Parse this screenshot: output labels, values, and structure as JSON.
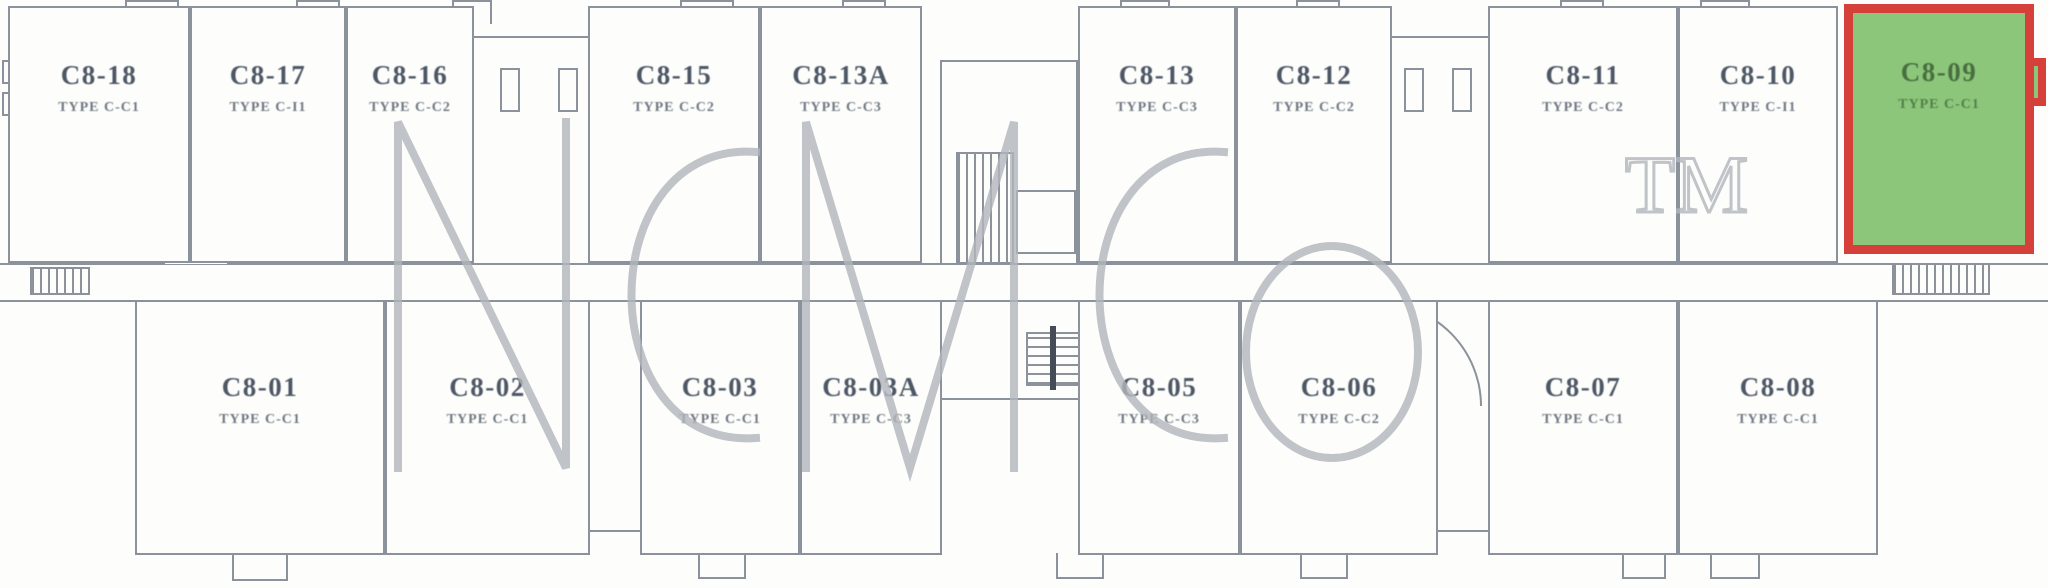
{
  "watermark": {
    "text": "NCMCo",
    "tm": "TM",
    "color": "#b2b6bc"
  },
  "highlight": {
    "unit": "C8-09",
    "fill": "#8cc67a",
    "border": "#d6403a"
  },
  "colors": {
    "line": "#8b929c",
    "ink": "#4d5765",
    "paper": "#fdfdfb"
  },
  "units": [
    {
      "id": "C8-18",
      "type": "TYPE C-C1",
      "row": "top",
      "x": 8,
      "y": 6,
      "w": 182,
      "h": 257,
      "highlighted": false
    },
    {
      "id": "C8-17",
      "type": "TYPE C-I1",
      "row": "top",
      "x": 190,
      "y": 6,
      "w": 156,
      "h": 257,
      "highlighted": false
    },
    {
      "id": "C8-16",
      "type": "TYPE C-C2",
      "row": "top",
      "x": 346,
      "y": 6,
      "w": 128,
      "h": 257,
      "highlighted": false
    },
    {
      "id": "C8-15",
      "type": "TYPE C-C2",
      "row": "top",
      "x": 588,
      "y": 6,
      "w": 172,
      "h": 257,
      "highlighted": false
    },
    {
      "id": "C8-13A",
      "type": "TYPE C-C3",
      "row": "top",
      "x": 760,
      "y": 6,
      "w": 162,
      "h": 257,
      "highlighted": false
    },
    {
      "id": "C8-13",
      "type": "TYPE C-C3",
      "row": "top",
      "x": 1078,
      "y": 6,
      "w": 158,
      "h": 257,
      "highlighted": false
    },
    {
      "id": "C8-12",
      "type": "TYPE C-C2",
      "row": "top",
      "x": 1236,
      "y": 6,
      "w": 156,
      "h": 257,
      "highlighted": false
    },
    {
      "id": "C8-11",
      "type": "TYPE C-C2",
      "row": "top",
      "x": 1488,
      "y": 6,
      "w": 190,
      "h": 257,
      "highlighted": false
    },
    {
      "id": "C8-10",
      "type": "TYPE C-I1",
      "row": "top",
      "x": 1678,
      "y": 6,
      "w": 160,
      "h": 257,
      "highlighted": false
    },
    {
      "id": "C8-09",
      "type": "TYPE C-C1",
      "row": "top",
      "x": 1844,
      "y": 4,
      "w": 190,
      "h": 250,
      "highlighted": true
    },
    {
      "id": "C8-01",
      "type": "TYPE C-C1",
      "row": "bottom",
      "x": 135,
      "y": 300,
      "w": 250,
      "h": 255,
      "highlighted": false
    },
    {
      "id": "C8-02",
      "type": "TYPE C-C1",
      "row": "bottom",
      "x": 385,
      "y": 300,
      "w": 205,
      "h": 255,
      "highlighted": false
    },
    {
      "id": "C8-03",
      "type": "TYPE C-C1",
      "row": "bottom",
      "x": 640,
      "y": 300,
      "w": 160,
      "h": 255,
      "highlighted": false
    },
    {
      "id": "C8-03A",
      "type": "TYPE C-C3",
      "row": "bottom",
      "x": 800,
      "y": 300,
      "w": 142,
      "h": 255,
      "highlighted": false
    },
    {
      "id": "C8-05",
      "type": "TYPE C-C3",
      "row": "bottom",
      "x": 1078,
      "y": 300,
      "w": 162,
      "h": 255,
      "highlighted": false
    },
    {
      "id": "C8-06",
      "type": "TYPE C-C2",
      "row": "bottom",
      "x": 1240,
      "y": 300,
      "w": 198,
      "h": 255,
      "highlighted": false
    },
    {
      "id": "C8-07",
      "type": "TYPE C-C1",
      "row": "bottom",
      "x": 1488,
      "y": 300,
      "w": 190,
      "h": 255,
      "highlighted": false
    },
    {
      "id": "C8-08",
      "type": "TYPE C-C1",
      "row": "bottom",
      "x": 1678,
      "y": 300,
      "w": 200,
      "h": 255,
      "highlighted": false
    }
  ],
  "decor": [
    [
      "hline",
      0,
      263,
      2048,
      0
    ],
    [
      "hline",
      0,
      300,
      2048,
      0
    ],
    [
      "hline",
      474,
      36,
      114,
      0
    ],
    [
      "hline",
      1392,
      36,
      96,
      0
    ],
    [
      "hline",
      590,
      530,
      50,
      0
    ],
    [
      "hline",
      1438,
      530,
      50,
      0
    ],
    [
      "box",
      940,
      60,
      138,
      205
    ],
    [
      "box",
      940,
      300,
      140,
      100
    ],
    [
      "box",
      1016,
      190,
      60,
      64
    ],
    [
      "hatch-v",
      956,
      152,
      58,
      112
    ],
    [
      "hatch-v",
      30,
      267,
      60,
      28
    ],
    [
      "hatch-v",
      1892,
      263,
      98,
      32
    ],
    [
      "stair",
      1026,
      332,
      58,
      54
    ],
    [
      "bar",
      1050,
      326,
      6,
      64
    ],
    [
      "window",
      2,
      60,
      16,
      24
    ],
    [
      "window",
      2,
      92,
      16,
      24
    ],
    [
      "pilaster",
      500,
      68,
      20,
      44
    ],
    [
      "pilaster",
      558,
      68,
      20,
      44
    ],
    [
      "pilaster",
      1404,
      68,
      20,
      44
    ],
    [
      "pilaster",
      1452,
      68,
      20,
      44
    ],
    [
      "duct",
      594,
      152,
      32,
      48
    ],
    [
      "duct",
      594,
      212,
      32,
      48
    ],
    [
      "duct",
      1280,
      152,
      32,
      48
    ],
    [
      "duct",
      1280,
      212,
      32,
      48
    ],
    [
      "duct",
      1624,
      148,
      38,
      46
    ],
    [
      "bay-top",
      125,
      0,
      54,
      28
    ],
    [
      "bay-top",
      296,
      0,
      44,
      24
    ],
    [
      "bay-top",
      452,
      0,
      40,
      24
    ],
    [
      "bay-top",
      680,
      0,
      54,
      28
    ],
    [
      "bay-top",
      842,
      0,
      44,
      24
    ],
    [
      "bay-top",
      1120,
      0,
      50,
      26
    ],
    [
      "bay-top",
      1296,
      0,
      44,
      24
    ],
    [
      "bay-top",
      1560,
      0,
      44,
      26
    ],
    [
      "bay-top",
      1700,
      0,
      50,
      26
    ],
    [
      "bay-bottom",
      232,
      553,
      56,
      28
    ],
    [
      "bay-bottom",
      698,
      553,
      48,
      26
    ],
    [
      "bay-bottom",
      1056,
      553,
      48,
      26
    ],
    [
      "bay-bottom",
      1300,
      553,
      48,
      26
    ],
    [
      "bay-bottom",
      1622,
      553,
      44,
      26
    ],
    [
      "bay-bottom",
      1710,
      553,
      50,
      26
    ],
    [
      "arch-up",
      163,
      219,
      66,
      45
    ],
    [
      "arch-up",
      755,
      219,
      60,
      44
    ],
    [
      "arch-down",
      317,
      300,
      66,
      45
    ],
    [
      "arch-down",
      750,
      300,
      62,
      44
    ],
    [
      "qarc",
      1090,
      302,
      88,
      88
    ],
    [
      "qarc",
      1378,
      302,
      104,
      104
    ],
    [
      "qarc",
      1545,
      302,
      120,
      120
    ],
    [
      "notch",
      1846,
      4,
      44,
      30
    ],
    [
      "bump",
      2030,
      58,
      16,
      48
    ]
  ]
}
